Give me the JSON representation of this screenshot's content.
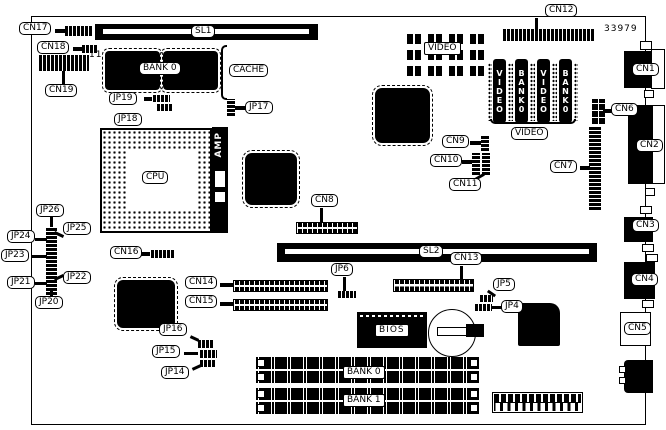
{
  "board": {
    "part_number": "33979"
  },
  "labels": {
    "cn1": "CN1",
    "cn2": "CN2",
    "cn3": "CN3",
    "cn4": "CN4",
    "cn5": "CN5",
    "cn6": "CN6",
    "cn7": "CN7",
    "cn8": "CN8",
    "cn9": "CN9",
    "cn10": "CN10",
    "cn11": "CN11",
    "cn12": "CN12",
    "cn13": "CN13",
    "cn14": "CN14",
    "cn15": "CN15",
    "cn16": "CN16",
    "cn17": "CN17",
    "cn18": "CN18",
    "cn19": "CN19",
    "jp4": "JP4",
    "jp5": "JP5",
    "jp6": "JP6",
    "jp14": "JP14",
    "jp15": "JP15",
    "jp16": "JP16",
    "jp17": "JP17",
    "jp18": "JP18",
    "jp19": "JP19",
    "jp20": "JP20",
    "jp21": "JP21",
    "jp22": "JP22",
    "jp23": "JP23",
    "jp24": "JP24",
    "jp25": "JP25",
    "jp26": "JP26",
    "sl1": "SL1",
    "sl2": "SL2",
    "cpu": "CPU",
    "amp": "AMP",
    "cache": "CACHE",
    "bios": "BIOS",
    "bank0": "BANK 0",
    "bank1": "BANK 1",
    "video": "VIDEO",
    "pin11": "11"
  },
  "sip_modules": [
    "VIDEO",
    "BANK0",
    "VIDEO",
    "BANK0"
  ]
}
